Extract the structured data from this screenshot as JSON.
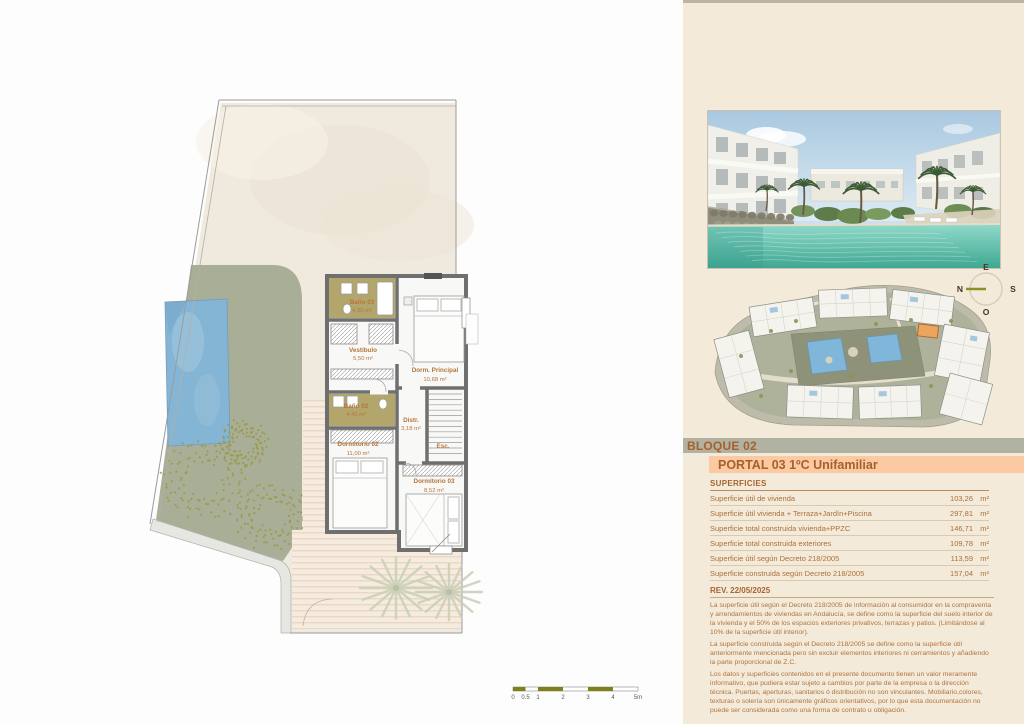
{
  "colors": {
    "accent_orange": "#b2672b",
    "salmon_bar": "#fbc9a2",
    "grey_bar": "#b2b2a3",
    "panel_bg": "#f4ead9",
    "garden_green": "#a9ae97",
    "pool_blue": "#85b5d5",
    "olive_room": "#b3a66d",
    "scale_olive": "#7f8019"
  },
  "floor_plan": {
    "rooms": [
      {
        "name": "Baño 03",
        "area": "4,30 m²"
      },
      {
        "name": "Vestíbulo",
        "area": "5,50 m²"
      },
      {
        "name": "Dorm. Principal",
        "area": "10,68 m²"
      },
      {
        "name": "Baño 02",
        "area": "4,40 m²"
      },
      {
        "name": "Distr.",
        "area": "3,18 m²"
      },
      {
        "name": "Dormitorio 02",
        "area": "11,00 m²"
      },
      {
        "name": "Esc.",
        "area": ""
      },
      {
        "name": "Dormitorio 03",
        "area": "8,52 m²"
      }
    ],
    "scale_labels": [
      "0",
      "0.5",
      "1",
      "2",
      "3",
      "4",
      "5m"
    ]
  },
  "compass": {
    "top": "E",
    "left": "N",
    "right": "S",
    "bottom": "O"
  },
  "panel": {
    "bloque": "BLOQUE 02",
    "portal": "PORTAL 03 1ºC Unifamiliar",
    "superficies_title": "SUPERFICIES",
    "superficies": [
      {
        "label": "Superficie útil de vivienda",
        "value": "103,26",
        "unit": "m²"
      },
      {
        "label": "Superficie útil vivienda + Terraza+Jardín+Piscina",
        "value": "297,81",
        "unit": "m²"
      },
      {
        "label": "Superficie total construida vivienda+PPZC",
        "value": "146,71",
        "unit": "m²"
      },
      {
        "label": "Superficie total construida exteriores",
        "value": "109,78",
        "unit": "m²"
      },
      {
        "label": "Superficie útil según Decreto 218/2005",
        "value": "113,59",
        "unit": "m²"
      },
      {
        "label": "Superficie construida según Decreto 218/2005",
        "value": "157,04",
        "unit": "m²"
      }
    ],
    "rev_title": "REV. 22/05/2025",
    "disclaimer": [
      "La superficie útil según el Decreto 218/2005 de información al consumidor en la compraventa y arrendamientos de viviendas en Andalucía, se define como la superficie del suelo interior de la vivienda y el 50% de los espacios exteriores privativos, terrazas y patios. (Limitándose al 10% de la superficie útil interior).",
      "La superficie construida según el Decreto 218/2005 se define como la superficie útil anteriormente mencionada pero sin excluir elementos interiores ni cerramientos y añadiendo la parte proporcional de Z.C.",
      "Los datos y superficies contenidos en el presente documento tienen un valor meramente informativo, que pudiera estar sujeto a cambios por parte de la empresa o la dirección técnica. Puertas, aperturas, sanitarios ó distribución no son vinculantes. Mobiliario,colores, texturas o solería son únicamente gráficos orientativos, por lo que esta documentación no puede ser considerada como una forma de contrato u obligación."
    ]
  }
}
